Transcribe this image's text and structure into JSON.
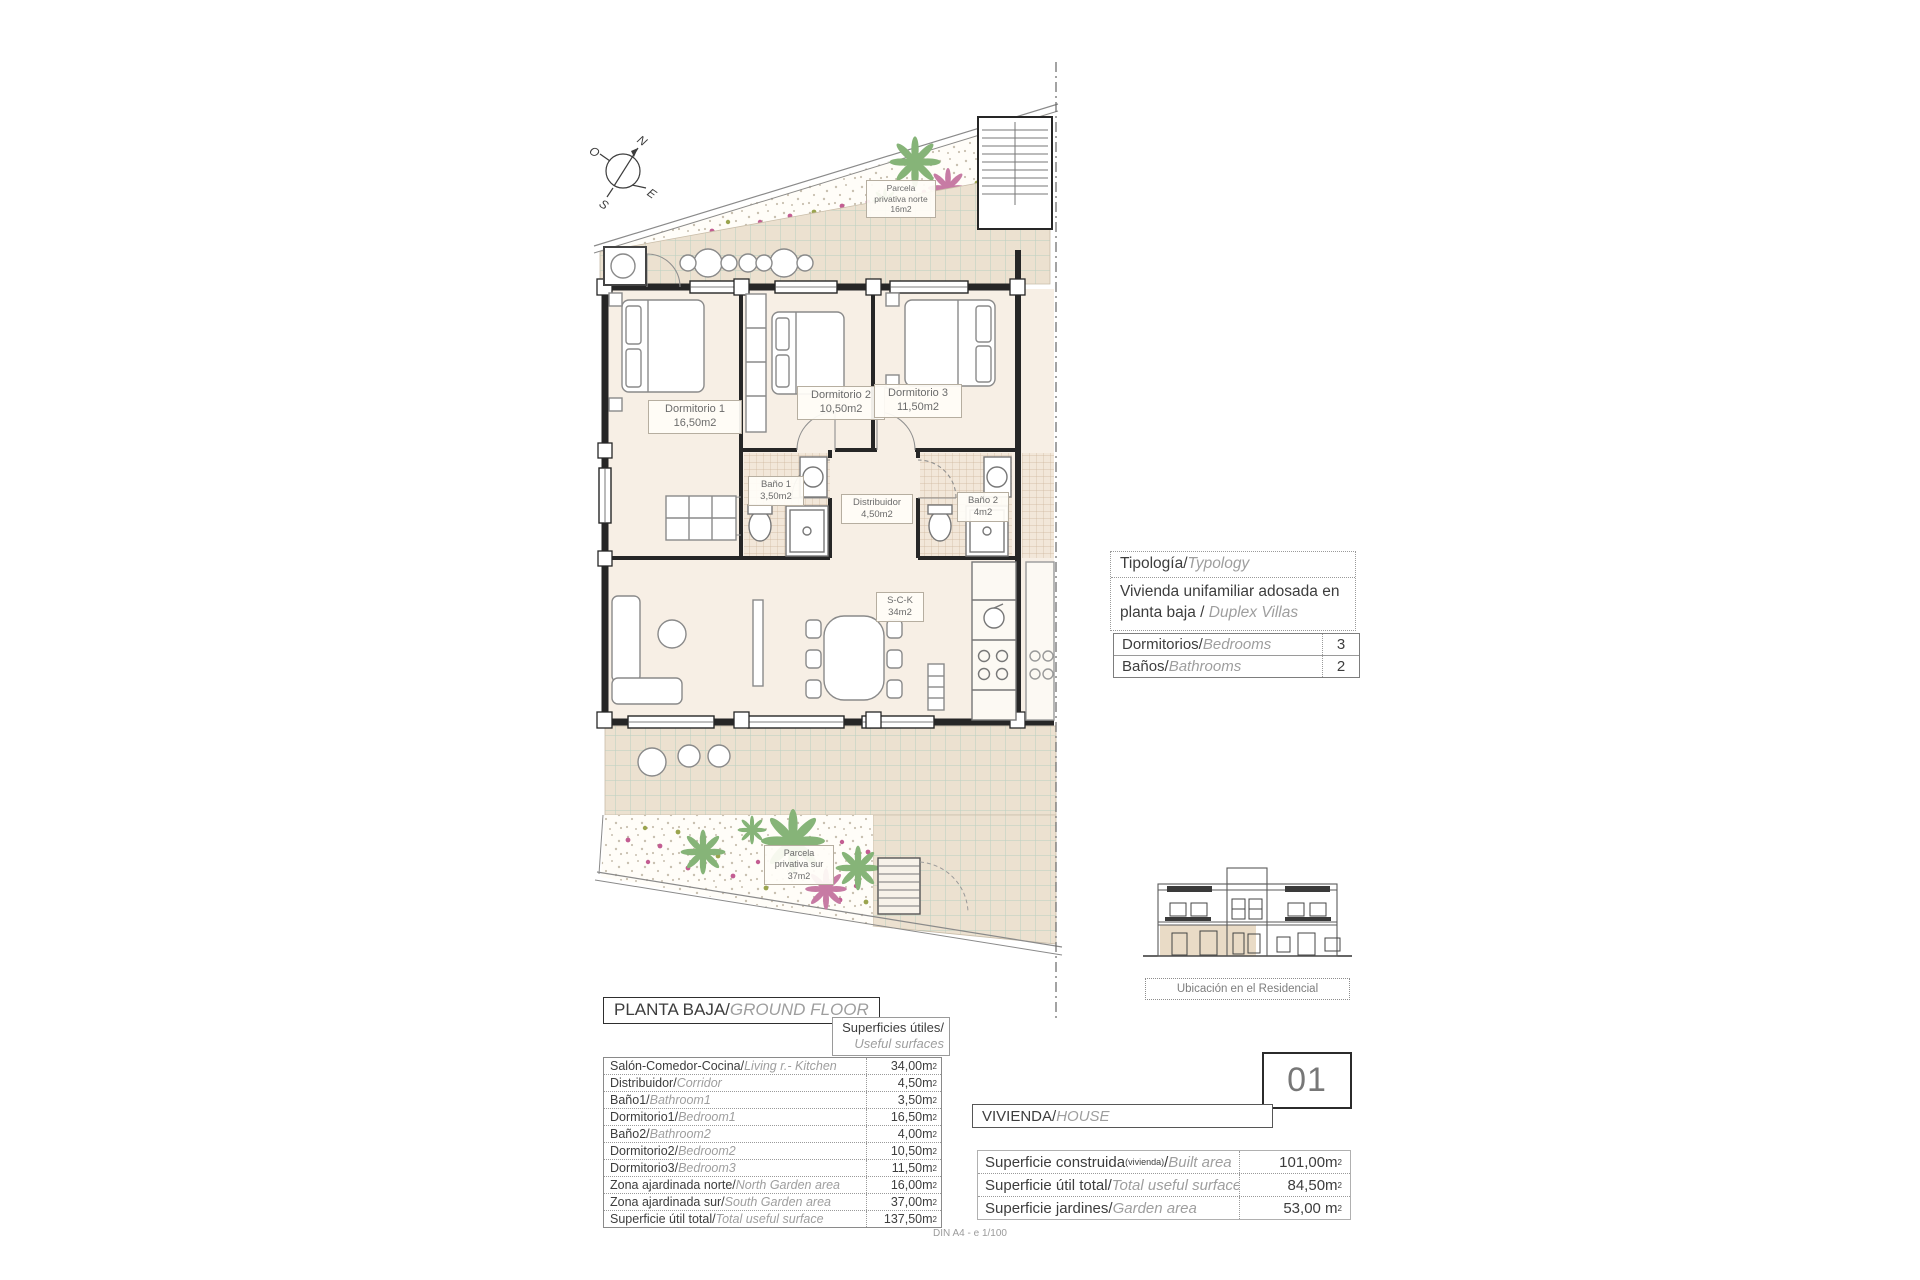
{
  "sheet": {
    "footer": "DIN A4 - e 1/100"
  },
  "compass": {
    "n": "N",
    "e": "E",
    "s": "S",
    "o": "O"
  },
  "plan": {
    "garden_north": {
      "l1": "Parcela",
      "l2": "privativa norte",
      "l3": "16m2"
    },
    "garden_south": {
      "l1": "Parcela",
      "l2": "privativa sur",
      "l3": "37m2"
    },
    "rooms": {
      "d1": {
        "name": "Dormitorio 1",
        "area": "16,50m2"
      },
      "d2": {
        "name": "Dormitorio 2",
        "area": "10,50m2"
      },
      "d3": {
        "name": "Dormitorio 3",
        "area": "11,50m2"
      },
      "b1": {
        "name": "Baño 1",
        "area": "3,50m2"
      },
      "dis": {
        "name": "Distribuidor",
        "area": "4,50m2"
      },
      "b2": {
        "name": "Baño 2",
        "area": "4m2"
      },
      "sck": {
        "name": "S-C-K",
        "area": "34m2"
      }
    }
  },
  "typology": {
    "title_es": "Tipología/",
    "title_en": "Typology",
    "body_es": "Vivienda unifamiliar adosada en planta baja / ",
    "body_en": "Duplex Villas"
  },
  "counts": {
    "rows": [
      {
        "es": "Dormitorios/",
        "en": "Bedrooms",
        "value": "3"
      },
      {
        "es": "Baños/",
        "en": "Bathrooms",
        "value": "2"
      }
    ]
  },
  "location": {
    "caption": "Ubicación en el Residencial"
  },
  "ground_floor": {
    "title_es": "PLANTA BAJA/",
    "title_en": "GROUND FLOOR",
    "surfaces_es": "Superficies útiles/",
    "surfaces_en": "Useful surfaces",
    "rows": [
      {
        "es": "Salón-Comedor-Cocina/",
        "en": "Living r.- Kitchen",
        "value": "34,00m",
        "sup": "2"
      },
      {
        "es": "Distribuidor/",
        "en": "Corridor",
        "value": "4,50m",
        "sup": "2"
      },
      {
        "es": "Baño1/",
        "en": "Bathroom1",
        "value": "3,50m",
        "sup": "2"
      },
      {
        "es": "Dormitorio1/",
        "en": "Bedroom1",
        "value": "16,50m",
        "sup": "2"
      },
      {
        "es": "Baño2/",
        "en": "Bathroom2",
        "value": "4,00m",
        "sup": "2"
      },
      {
        "es": "Dormitorio2/",
        "en": "Bedroom2",
        "value": "10,50m",
        "sup": "2"
      },
      {
        "es": "Dormitorio3/",
        "en": "Bedroom3",
        "value": "11,50m",
        "sup": "2"
      },
      {
        "es": "Zona ajardinada norte/",
        "en": "North Garden area",
        "value": "16,00m",
        "sup": "2"
      },
      {
        "es": "Zona ajardinada sur/",
        "en": "South Garden area",
        "value": "37,00m",
        "sup": "2"
      },
      {
        "es": "Superficie útil total/",
        "en": "Total useful surface",
        "value": "137,50m",
        "sup": "2"
      }
    ]
  },
  "house": {
    "number": "01",
    "label_es": "VIVIENDA/",
    "label_en": "HOUSE",
    "rows": [
      {
        "es": "Superficie construida",
        "paren": "(vivienda)",
        "slash": "/",
        "en": "Built area",
        "value": "101,00m",
        "sup": "2"
      },
      {
        "es": "Superficie útil total/",
        "en": "Total useful surfaces",
        "value": "84,50m",
        "sup": "2"
      },
      {
        "es": "Superficie jardines/",
        "en": "Garden area",
        "value": "53,00 m",
        "sup": "2"
      }
    ]
  }
}
